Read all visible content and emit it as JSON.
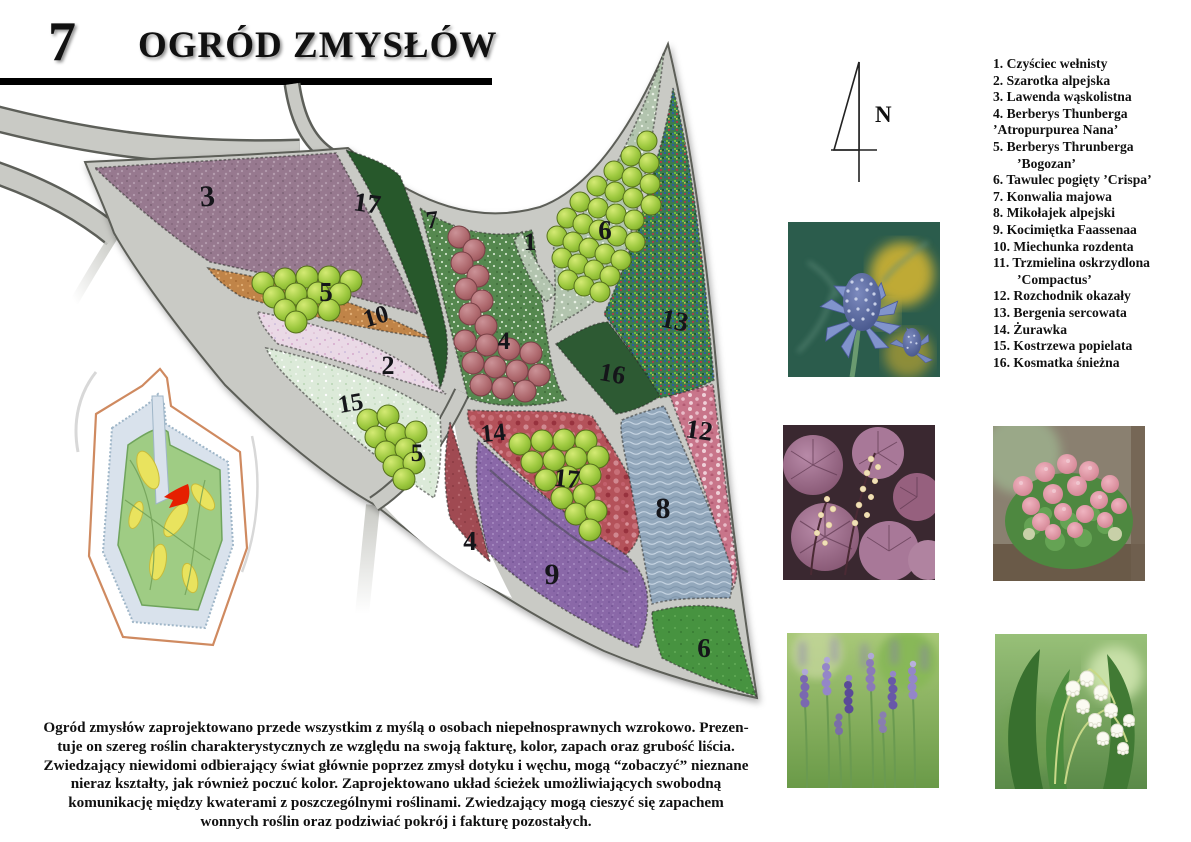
{
  "header": {
    "page_number": "7",
    "title": "OGRÓD ZMYSŁÓW"
  },
  "compass": {
    "label": "N"
  },
  "plant_list": {
    "items": [
      {
        "text": "1. Czyściec wełnisty",
        "indent": false
      },
      {
        "text": "2. Szarotka alpejska",
        "indent": false
      },
      {
        "text": "3. Lawenda wąskolistna",
        "indent": false
      },
      {
        "text": "4. Berberys Thunberga",
        "indent": false
      },
      {
        "text": "’Atropurpurea Nana’",
        "indent": false
      },
      {
        "text": "5. Berberys Thrunberga",
        "indent": false
      },
      {
        "text": "’Bogozan’",
        "indent": true
      },
      {
        "text": "6. Tawulec pogięty ’Crispa’",
        "indent": false
      },
      {
        "text": "7. Konwalia majowa",
        "indent": false
      },
      {
        "text": "8. Mikołajek alpejski",
        "indent": false
      },
      {
        "text": "9. Kocimiętka Faassenaa",
        "indent": false
      },
      {
        "text": "10. Miechunka rozdenta",
        "indent": false
      },
      {
        "text": "11. Trzmielina oskrzydlona",
        "indent": false
      },
      {
        "text": "’Compactus’",
        "indent": true
      },
      {
        "text": "12. Rozchodnik okazały",
        "indent": false
      },
      {
        "text": "13. Bergenia sercowata",
        "indent": false
      },
      {
        "text": "14. Żurawka",
        "indent": false
      },
      {
        "text": "15. Kostrzewa popielata",
        "indent": false
      },
      {
        "text": "16. Kosmatka śnieżna",
        "indent": false
      }
    ]
  },
  "plan": {
    "labels": [
      {
        "text": "3",
        "x": 208,
        "y": 206,
        "rot": -4,
        "size": 30
      },
      {
        "text": "17",
        "x": 366,
        "y": 212,
        "rot": 8,
        "size": 27
      },
      {
        "text": "7",
        "x": 433,
        "y": 228,
        "rot": -6,
        "size": 25
      },
      {
        "text": "1",
        "x": 530,
        "y": 250,
        "rot": 0,
        "size": 25
      },
      {
        "text": "6",
        "x": 605,
        "y": 239,
        "rot": 0,
        "size": 27
      },
      {
        "text": "5",
        "x": 326,
        "y": 301,
        "rot": 0,
        "size": 27
      },
      {
        "text": "10",
        "x": 378,
        "y": 324,
        "rot": -16,
        "size": 25
      },
      {
        "text": "13",
        "x": 673,
        "y": 329,
        "rot": 12,
        "size": 27
      },
      {
        "text": "4",
        "x": 504,
        "y": 349,
        "rot": 0,
        "size": 25
      },
      {
        "text": "2",
        "x": 388,
        "y": 374,
        "rot": 0,
        "size": 26
      },
      {
        "text": "16",
        "x": 611,
        "y": 382,
        "rot": 10,
        "size": 26
      },
      {
        "text": "15",
        "x": 352,
        "y": 411,
        "rot": -10,
        "size": 25
      },
      {
        "text": "12",
        "x": 698,
        "y": 439,
        "rot": 8,
        "size": 27
      },
      {
        "text": "14",
        "x": 494,
        "y": 441,
        "rot": -6,
        "size": 25
      },
      {
        "text": "5",
        "x": 417,
        "y": 461,
        "rot": 0,
        "size": 25
      },
      {
        "text": "17",
        "x": 566,
        "y": 487,
        "rot": 6,
        "size": 26
      },
      {
        "text": "8",
        "x": 663,
        "y": 518,
        "rot": 0,
        "size": 30
      },
      {
        "text": "4",
        "x": 470,
        "y": 550,
        "rot": 0,
        "size": 27
      },
      {
        "text": "9",
        "x": 552,
        "y": 584,
        "rot": 0,
        "size": 30
      },
      {
        "text": "6",
        "x": 704,
        "y": 657,
        "rot": 0,
        "size": 27
      }
    ]
  },
  "photos": [
    {
      "subject": "blue sea holly thistle flowers"
    },
    {
      "subject": "purple heuchera leaves with cream flower sprays"
    },
    {
      "subject": "pink sedum flower clusters"
    },
    {
      "subject": "purple lavender spikes"
    },
    {
      "subject": "white lily of the valley bells"
    }
  ],
  "paragraph": {
    "lines": [
      "Ogród zmysłów zaprojektowano przede wszystkim  z myślą o osobach niepełnosprawnych wzrokowo. Prezen-",
      "tuje on szereg roślin charakterystycznych ze względu na swoją fakturę, kolor, zapach oraz grubość liścia.",
      "Zwiedzający niewidomi odbierający świat głównie poprzez zmysł dotyku i węchu, mogą “zobaczyć” nieznane",
      "nieraz kształty, jak również poczuć kolor. Zaprojektowano układ ścieżek umożliwiających swobodną",
      "komunikację między kwaterami z poszczególnymi roślinami. Zwiedzający mogą cieszyć się zapachem",
      "wonnych roślin oraz podziwiać pokrój i fakturę pozostałych."
    ]
  },
  "colors": {
    "path_gray": "#c9cac5",
    "path_edge": "#5d5f59",
    "bed_mauve": "#97798f",
    "bed_orange": "#c08448",
    "bed_pink_light": "#ead9e6",
    "bed_mint": "#dcead9",
    "bed_green_speckled": "#55884f",
    "bed_sage": "#b2c4ae",
    "bed_noise_green": "#3b7a50",
    "bed_crimson": "#b4525a",
    "bed_pink": "#c8758a",
    "bed_blue": "#93a8bc",
    "bed_purple": "#8a68a8",
    "bed_dark_red": "#a04a52",
    "bed_dark_green": "#27582b",
    "bed_forest": "#2d5a33",
    "bed_green": "#479340",
    "bush_lime": "#9cc83e",
    "bush_maroon": "#b06a6d",
    "inset_outline": "#cf8a60",
    "inset_marker_red": "#e51f00"
  }
}
